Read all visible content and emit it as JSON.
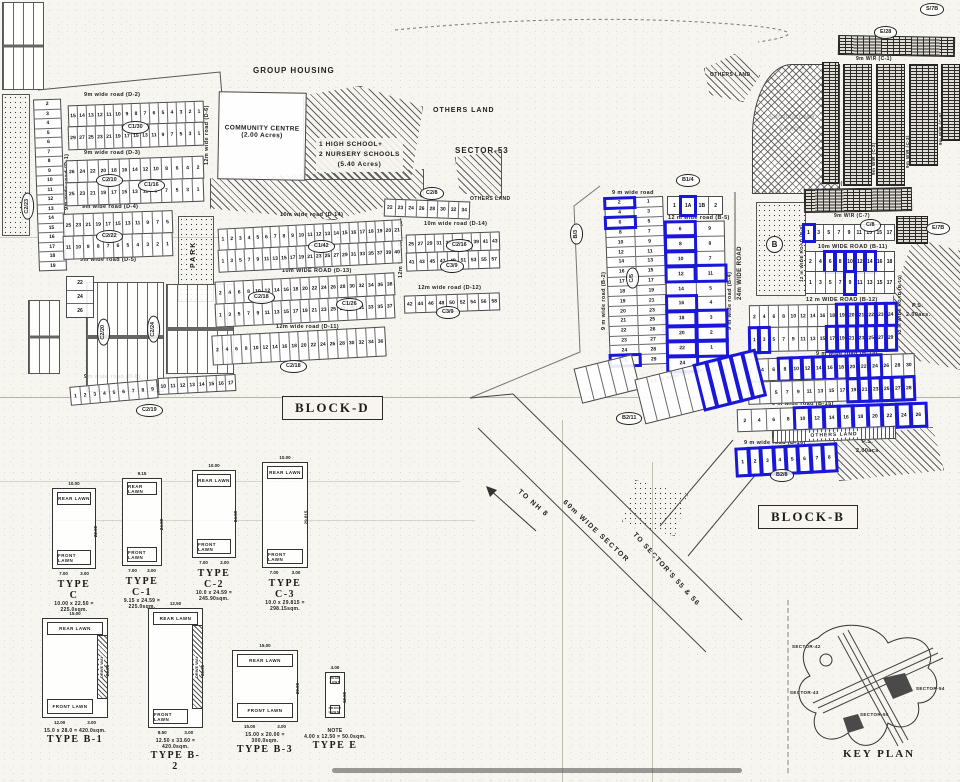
{
  "colors": {
    "highlight": "#1a18d8",
    "ink": "#1d1d1d",
    "paper": "#f7f5f0"
  },
  "texts": {
    "group_housing": "GROUP HOUSING",
    "community_1": "COMMUNITY CENTRE",
    "community_2": "(2.00 Acres)",
    "school_1": "1  HIGH SCHOOL+",
    "school_2": "2  NURSERY SCHOOLS",
    "school_3": "(5.40 Acres)",
    "others_land_sector": "OTHERS LAND",
    "sector53": "SECTOR-53",
    "block_d": "BLOCK-D",
    "block_b": "BLOCK-B",
    "park": "PARK",
    "others_land_ne": "OTHERS LAND",
    "others_land_strip": "OTHERS LAND",
    "shopp_1": "SHOPP/COMM.",
    "shopp_2": "2 EACS.",
    "ns_1": "N.S.",
    "ns_2": "0.32acs.",
    "ps_1": "P.S.",
    "ps_2": "2.00acs.",
    "to_nh8": "TO NH 8",
    "sector_road": "60m WIDE SECTOR",
    "to_sectors": "TO SECTOR'S 55 & 56",
    "road_24m": "24m WIDE ROAD",
    "road_18m": "18 m W\\R"
  },
  "refs": {
    "c2_23": "C2/23",
    "c1_30": "C1/30",
    "c2_10": "C2/10",
    "c1_16": "C1/16",
    "c2_22": "C2/22",
    "c1_42": "C1/42",
    "c2_18a": "C2/18",
    "c1_26": "C1/26",
    "c2_16": "C2/16",
    "c3_9a": "C3/9",
    "c3_9b": "C3/9",
    "c2_18b": "C2/18",
    "c2_19": "C2/19",
    "c2_20": "C2/20",
    "c2_24": "C2/24",
    "c2_8": "C2/8",
    "b1_4": "B1/4",
    "b_3": "B/3",
    "c_5": "C/5",
    "b2_11": "B2/11",
    "b2_8": "B2/8",
    "e28": "E/28",
    "c8": "C/8",
    "e7b": "E/7B",
    "s7b": "S/7B",
    "b_circle": "B"
  },
  "roads_d": [
    "9m wide road (D-2)",
    "9m wide road (D-3)",
    "9m wide road (D-4)",
    "9m wide road (D-5)",
    "9m wide road (D-1)",
    "10m wide road (D-14)",
    "10m WIDE ROAD (D-13)",
    "12m wide road (D-11)",
    "10m wide road (D-14)",
    "12m wide road (D-12)",
    "9m wide road (D-8)",
    "12m wide road (D-6)",
    "12m WIDE ROAD (D-7)"
  ],
  "roads_b": [
    "9 m wide road",
    "12 m wide road (B-5)",
    "9 m wide road (B-2)",
    "9 m wide road (B-3)",
    "9 m wide road (B-4)",
    "10m WIDE ROAD (B-11)",
    "12 m WIDE ROAD (B-12)",
    "9 m wide road (B-14)",
    "9 m wide road (B-15)",
    "9 m wide road (B-16)",
    "12 m wide road (B-6)",
    "12 m WIDE ROAD (B-8)",
    "12 m WIDE ROAD (B-10)"
  ],
  "roads_c": [
    "9m W\\R (C-1)",
    "9m W\\R (C-2)",
    "9m W\\R (C-3)",
    "9m W\\R (C-5)",
    "9m W\\R (C-6)",
    "9m W\\R (C-7)"
  ],
  "d": {
    "left_col": {
      "cells": [
        "2",
        "3",
        "4",
        "5",
        "6",
        "7",
        "8",
        "9",
        "10",
        "11",
        "12",
        "13",
        "14",
        "15",
        "16",
        "17",
        "18",
        "19"
      ]
    },
    "left_col2": {
      "cells": [
        "22",
        "24",
        "26"
      ]
    },
    "b1": {
      "cells": [
        "15",
        "14",
        "13",
        "12",
        "11",
        "10",
        "9",
        "8",
        "7",
        "6",
        "5",
        "4",
        "3",
        "2",
        "1"
      ]
    },
    "b2": {
      "cells": [
        "29",
        "27",
        "25",
        "23",
        "21",
        "19",
        "17",
        "15",
        "13",
        "11",
        "9",
        "7",
        "5",
        "3",
        "1"
      ]
    },
    "c1": {
      "cells": [
        "26",
        "24",
        "22",
        "20",
        "18",
        "16",
        "14",
        "12",
        "10",
        "8",
        "6",
        "4",
        "2"
      ]
    },
    "c2": {
      "cells": [
        "25",
        "23",
        "21",
        "19",
        "17",
        "15",
        "13",
        "11",
        "9",
        "7",
        "5",
        "3",
        "1"
      ]
    },
    "d1": {
      "cells": [
        "25",
        "23",
        "21",
        "19",
        "17",
        "15",
        "13",
        "11",
        "9",
        "7",
        "5"
      ]
    },
    "d2": {
      "cells": [
        "11",
        "10",
        "9",
        "8",
        "7",
        "6",
        "5",
        "4",
        "3",
        "2",
        "1"
      ]
    },
    "e1": {
      "cells": [
        "1",
        "2",
        "3",
        "4",
        "5",
        "6",
        "7",
        "8",
        "9",
        "10",
        "11",
        "12",
        "13",
        "14",
        "15",
        "16",
        "17",
        "18",
        "19",
        "20",
        "21"
      ]
    },
    "e2": {
      "cells": [
        "1",
        "3",
        "5",
        "7",
        "9",
        "11",
        "13",
        "15",
        "17",
        "19",
        "21",
        "23",
        "25",
        "27",
        "29",
        "31",
        "33",
        "35",
        "37",
        "39",
        "40"
      ]
    },
    "f1": {
      "cells": [
        "2",
        "4",
        "6",
        "8",
        "10",
        "12",
        "14",
        "16",
        "18",
        "20",
        "22",
        "24",
        "26",
        "28",
        "30",
        "32",
        "34",
        "36",
        "38"
      ]
    },
    "f2": {
      "cells": [
        "1",
        "3",
        "5",
        "7",
        "9",
        "11",
        "13",
        "15",
        "17",
        "19",
        "21",
        "23",
        "25",
        "27",
        "29",
        "31",
        "33",
        "35",
        "37"
      ]
    },
    "g1": {
      "cells": [
        "2",
        "4",
        "6",
        "8",
        "10",
        "12",
        "14",
        "16",
        "18",
        "20",
        "22",
        "24",
        "26",
        "28",
        "30",
        "32",
        "34",
        "36"
      ]
    },
    "h1": {
      "cells": [
        "1",
        "2",
        "3",
        "4",
        "5",
        "6",
        "7",
        "8",
        "9"
      ]
    },
    "h2": {
      "cells": [
        "10",
        "11",
        "12",
        "13",
        "14",
        "15",
        "16",
        "17"
      ]
    },
    "tr": {
      "cells": [
        "22",
        "23",
        "24",
        "26",
        "28",
        "30",
        "32",
        "34"
      ]
    },
    "ra": {
      "cells": [
        "25",
        "27",
        "29",
        "31",
        "33",
        "35",
        "37",
        "39",
        "41",
        "43"
      ]
    },
    "rb": {
      "cells": [
        "41",
        "43",
        "45",
        "47",
        "49",
        "51",
        "53",
        "55",
        "57"
      ]
    },
    "rc": {
      "cells": [
        "42",
        "44",
        "46",
        "48",
        "50",
        "52",
        "54",
        "56",
        "58"
      ]
    }
  },
  "b": {
    "left_colA": {
      "cells": [
        "2",
        "4",
        "6",
        "8",
        "10",
        "12",
        "14",
        "16",
        "17",
        "18",
        "19",
        "20",
        "21",
        "22",
        "23",
        "24",
        "25"
      ],
      "blue": [
        0,
        2,
        16
      ]
    },
    "left_colB": {
      "cells": [
        "1",
        "3",
        "5",
        "7",
        "9",
        "11",
        "13",
        "15",
        "17",
        "19",
        "21",
        "23",
        "25",
        "26",
        "27",
        "28",
        "29"
      ],
      "blue": []
    },
    "colC": {
      "cells": [
        "6",
        "8",
        "10",
        "12",
        "14",
        "16",
        "18",
        "20",
        "22",
        "24"
      ],
      "blue": [
        0,
        1,
        2,
        3,
        5,
        6,
        7,
        8,
        9
      ]
    },
    "colD": {
      "cells": [
        "9",
        "8",
        "7",
        "11",
        "5",
        "4",
        "3",
        "2",
        "1",
        "1A"
      ],
      "blue": [
        3,
        6,
        7,
        8
      ]
    },
    "top": {
      "cells": [
        "1",
        "1A",
        "1B",
        "2"
      ],
      "blue": [
        1
      ]
    },
    "rot": {
      "cells": [
        "",
        "",
        "",
        "",
        "",
        "",
        "",
        "",
        "",
        ""
      ],
      "blue": [
        5,
        6,
        7,
        8,
        9
      ]
    },
    "rot2": {
      "cells": [
        "",
        "",
        "",
        "",
        ""
      ],
      "blue": []
    },
    "rows": [
      {
        "cells": [
          "1",
          "3",
          "5",
          "7",
          "9",
          "11",
          "13",
          "15",
          "17"
        ],
        "blue": [
          0
        ]
      },
      {
        "cells": [
          "2",
          "4",
          "6",
          "8",
          "10",
          "12",
          "14",
          "16",
          "18"
        ],
        "blue": [
          2,
          3,
          4,
          5,
          6
        ]
      },
      {
        "cells": [
          "1",
          "3",
          "5",
          "7",
          "9",
          "11",
          "13",
          "15",
          "17"
        ],
        "blue": [
          4
        ]
      },
      {
        "cells": [
          "2",
          "4",
          "6",
          "8",
          "10",
          "12",
          "14",
          "16",
          "18",
          "19",
          "20",
          "21",
          "22",
          "23",
          "24"
        ],
        "blue": [
          9,
          10,
          11,
          12,
          13,
          14
        ]
      },
      {
        "cells": [
          "1",
          "3",
          "5",
          "7",
          "9",
          "11",
          "13",
          "15",
          "17",
          "19",
          "21",
          "23",
          "25",
          "27",
          "29"
        ],
        "blue": [
          0,
          1,
          8,
          9,
          10,
          11,
          12,
          13,
          14
        ]
      },
      {
        "cells": [
          "2",
          "4",
          "6",
          "8",
          "10",
          "12",
          "14",
          "16",
          "18",
          "20",
          "22",
          "24",
          "26",
          "28",
          "30"
        ],
        "blue": [
          3,
          4,
          5,
          6,
          7,
          8,
          9,
          10,
          11
        ]
      },
      {
        "cells": [
          "1",
          "3",
          "5",
          "7",
          "9",
          "11",
          "13",
          "15",
          "17",
          "19",
          "21",
          "23",
          "25",
          "27",
          "28"
        ],
        "blue": [
          9,
          10,
          11,
          12,
          13,
          14
        ]
      },
      {
        "cells": [
          "2",
          "4",
          "6",
          "8",
          "10",
          "12",
          "14",
          "16",
          "18",
          "20",
          "22",
          "24",
          "26"
        ],
        "blue": [
          4,
          5,
          6,
          7,
          8,
          9,
          10,
          11,
          12
        ]
      },
      {
        "cells": [
          "1",
          "2",
          "3",
          "4",
          "5",
          "6",
          "7",
          "8"
        ],
        "blue": [
          0,
          1,
          2,
          3,
          4,
          5,
          6,
          7
        ]
      }
    ]
  },
  "common": {
    "rear": "REAR LAWN",
    "front": "FRONT LAWN",
    "drive": "DRIVE WAY",
    "note": "NOTE"
  },
  "types": [
    {
      "name": "TYPE C",
      "dims": "10.00 x 22.50 = 225.0sqm.",
      "w": "10.00",
      "h": "22.50",
      "b1": "7.00",
      "b2": "3.00"
    },
    {
      "name": "TYPE C-1",
      "dims": "9.15 x 24.59 = 225.0sqm.",
      "w": "9.15",
      "h": "24.59",
      "b1": "7.00",
      "b2": "3.00"
    },
    {
      "name": "TYPE C-2",
      "dims": "10.0 x 24.59 = 245.90sqm.",
      "w": "10.00",
      "h": "24.59",
      "b1": "7.00",
      "b2": "3.00"
    },
    {
      "name": "TYPE C-3",
      "dims": "10.0 x 29.815 = 298.15sqm.",
      "w": "10.00",
      "h": "29.815",
      "b1": "7.00",
      "b2": "3.00"
    },
    {
      "name": "TYPE B-1",
      "dims": "15.0 x 28.0 = 420.0sqm.",
      "w": "15.00",
      "h": "28.00",
      "b1": "12.00",
      "b2": "3.00"
    },
    {
      "name": "TYPE B-2",
      "dims": "12.50 x 33.60 = 420.0sqm.",
      "w": "12.50",
      "h": "33.60",
      "b1": "8.50",
      "b2": "3.00"
    },
    {
      "name": "TYPE B-3",
      "dims": "15.00 x 20.00 = 300.0sqm.",
      "w": "15.00",
      "h": "20.00",
      "b1": "15.00",
      "b2": "3.00"
    },
    {
      "name": "TYPE E",
      "dims": "4.00 x 12.50 = 50.0sqm.",
      "w": "4.00",
      "h": "12.50",
      "b1": "",
      "b2": ""
    }
  ],
  "keyplan": {
    "caption": "KEY PLAN",
    "sectors": [
      "SECTOR-42",
      "SECTOR-43",
      "SECTOR-54",
      "SECTOR-55"
    ]
  }
}
